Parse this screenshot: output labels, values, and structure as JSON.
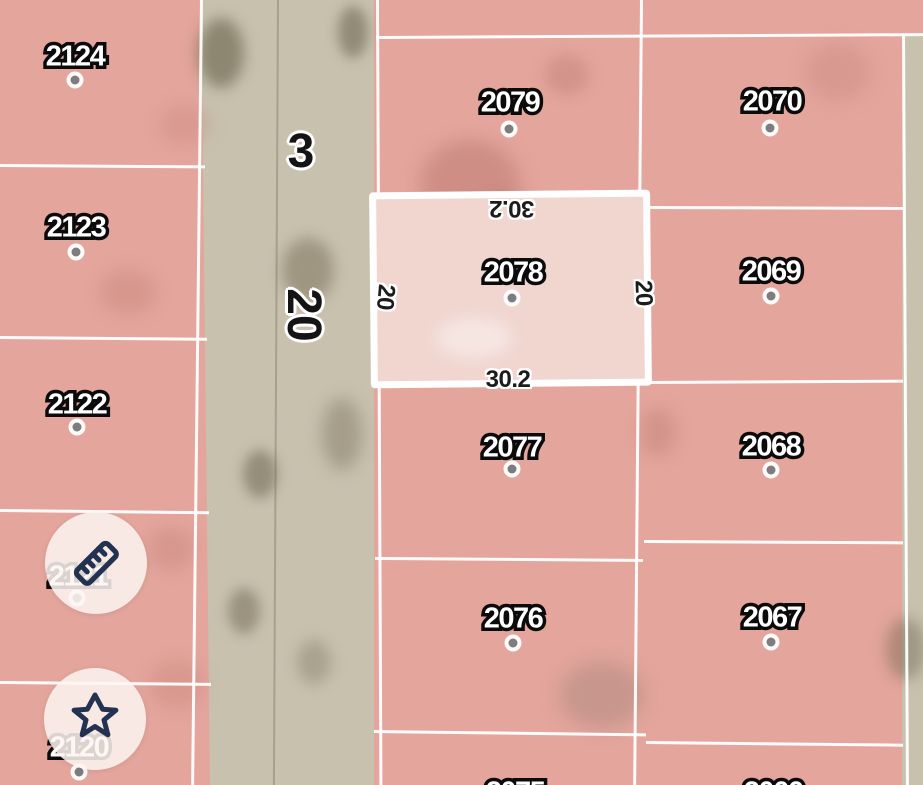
{
  "map": {
    "road": {
      "number": "3",
      "width_label": "20"
    },
    "selected_parcel": {
      "id": "2078",
      "dim_top": "30.2",
      "dim_bottom": "30.2",
      "dim_left": "20",
      "dim_right": "20"
    },
    "parcels": [
      {
        "id": "2124"
      },
      {
        "id": "2123"
      },
      {
        "id": "2122"
      },
      {
        "id": "2121"
      },
      {
        "id": "2120"
      },
      {
        "id": "2079"
      },
      {
        "id": "2077"
      },
      {
        "id": "2076"
      },
      {
        "id": "2075"
      },
      {
        "id": "2070"
      },
      {
        "id": "2069"
      },
      {
        "id": "2068"
      },
      {
        "id": "2067"
      },
      {
        "id": "2066"
      }
    ],
    "colors": {
      "parcel_fill": "#e3a59c",
      "selected_fill": "#f1d6d0",
      "road_fill": "#c8c1ae",
      "boundary": "#ffffff",
      "label_fill": "#ffffff",
      "label_outline": "#0b0b0b",
      "dimension_text": "#1c1c1c",
      "icon_navy": "#243252",
      "control_bg": "#fdf4f1"
    }
  },
  "controls": {
    "measure_tool_icon": "ruler-icon",
    "favorite_tool_icon": "star-icon"
  }
}
